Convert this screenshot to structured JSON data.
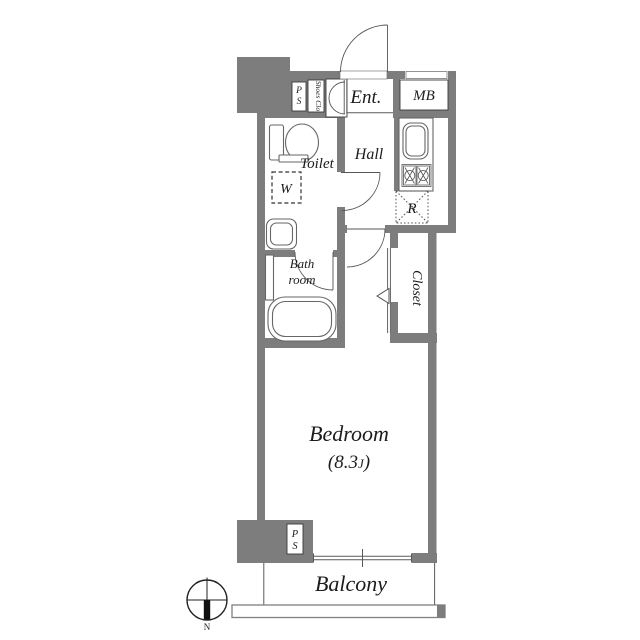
{
  "plan": {
    "type": "apartment-floor-plan",
    "labels": {
      "ps_top_line1": "P",
      "ps_top_line2": "S",
      "shoes_closet": "Shoes Clo",
      "entrance": "Ent.",
      "meter_box": "MB",
      "toilet": "Toilet",
      "washer_space": "W",
      "hall": "Hall",
      "refrigerator_space": "R",
      "bathroom_line1": "Bath",
      "bathroom_line2": "room",
      "closet": "Closet",
      "bedroom": "Bedroom",
      "bedroom_area_prefix": "(8.3",
      "bedroom_area_unit": "J",
      "bedroom_area_suffix": ")",
      "ps_bottom_line1": "P",
      "ps_bottom_line2": "S",
      "balcony": "Balcony",
      "compass_north": "N"
    },
    "colors": {
      "wall": "#7d7d7d",
      "line": "#5a5a5a",
      "text": "#1c1c1c",
      "background": "#ffffff"
    }
  }
}
